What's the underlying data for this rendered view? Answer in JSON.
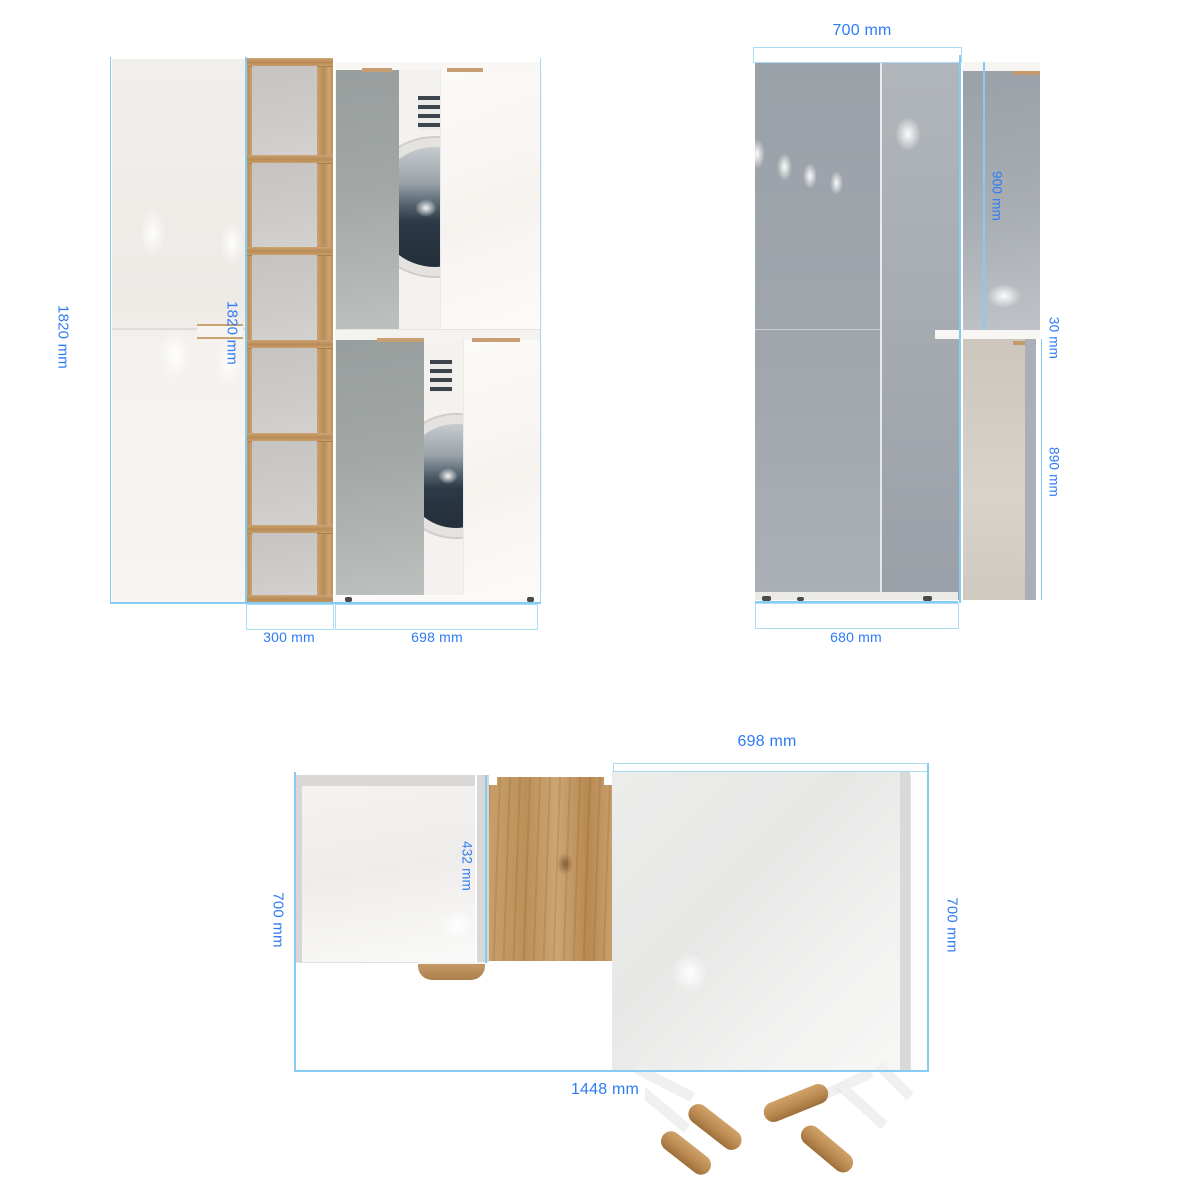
{
  "views": {
    "front": {
      "height_label": "1820 mm",
      "inner_height_label": "1820 mm",
      "shelf_width_label": "300 mm",
      "cabinet_width_label": "698 mm"
    },
    "side": {
      "depth_label": "700 mm",
      "door_height_label": "900 mm",
      "top_gap_label": "30 mm",
      "lower_panel_label": "890 mm",
      "base_depth_label": "680 mm"
    },
    "top": {
      "cabinet_width_label": "698 mm",
      "left_depth_label": "700 mm",
      "right_depth_label": "700 mm",
      "inner_depth_label": "432 mm",
      "total_width_label": "1448 mm"
    }
  },
  "colors": {
    "dimension_text": "#2e7bf6",
    "selection_outline": "#85ccf4",
    "wood": "#c49a6c",
    "mirror_grey": "#a2a7a6"
  }
}
